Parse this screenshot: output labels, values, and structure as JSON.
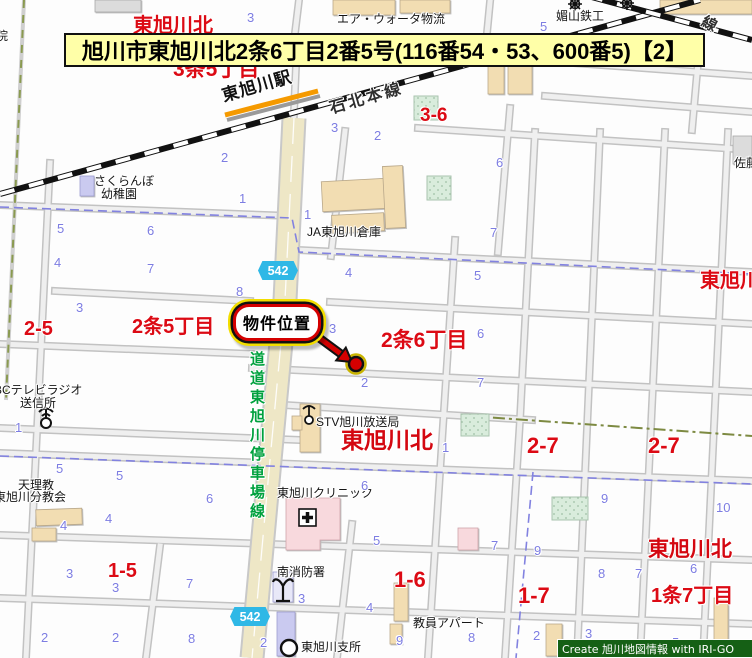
{
  "banner": {
    "text": "旭川市東旭川北2条6丁目2番5号(116番54・53、600番5)【2】"
  },
  "callout": {
    "label": "物件位置"
  },
  "credit": {
    "text": "Create 旭川地図情報 with IRI-GO"
  },
  "route_badges": [
    {
      "number": "542"
    },
    {
      "number": "542"
    }
  ],
  "colors": {
    "banner_bg": "#ffffa8",
    "area_label_red": "#dc0a14",
    "block_number_blue": "#7d7de2",
    "road_label_green": "#00a13e",
    "route_badge_cyan": "#2fb8e6",
    "pref_road_beige": "#eee7c6",
    "callout_red": "#d40000",
    "callout_outline_yellow": "#f2dd00",
    "credit_bg": "#156015",
    "platform_orange": "#f59a00"
  },
  "map_labels": [
    {
      "text": "東旭川北",
      "x": 133,
      "y": 16,
      "cls": "red",
      "size": 20,
      "name": "area-label-higashiasahikawakita-top"
    },
    {
      "text": "東旭川北",
      "x": 348,
      "y": 46,
      "cls": "red",
      "size": 20,
      "name": "area-label-higashiasahikawakita-hidden"
    },
    {
      "text": "3条5丁目",
      "x": 173,
      "y": 59,
      "cls": "red",
      "size": 21,
      "name": "area-label-3jo5chome"
    },
    {
      "text": "3-6",
      "x": 420,
      "y": 106,
      "cls": "red",
      "size": 19,
      "name": "block-label-3-6"
    },
    {
      "text": "東旭川",
      "x": 700,
      "y": 271,
      "cls": "red",
      "size": 20,
      "name": "area-label-higashiasahikawa-right"
    },
    {
      "text": "2-5",
      "x": 24,
      "y": 319,
      "cls": "red",
      "size": 20,
      "name": "block-label-2-5"
    },
    {
      "text": "2条5丁目",
      "x": 132,
      "y": 317,
      "cls": "red",
      "size": 20,
      "name": "area-label-2jo5chome"
    },
    {
      "text": "2条6丁目",
      "x": 381,
      "y": 330,
      "cls": "red",
      "size": 21,
      "name": "area-label-2jo6chome"
    },
    {
      "text": "東旭川北",
      "x": 341,
      "y": 429,
      "cls": "red-bold",
      "size": 23,
      "name": "area-label-higashiasahikawakita-center"
    },
    {
      "text": "2-7",
      "x": 527,
      "y": 435,
      "cls": "red",
      "size": 22,
      "name": "block-label-2-7a"
    },
    {
      "text": "2-7",
      "x": 648,
      "y": 435,
      "cls": "red",
      "size": 22,
      "name": "block-label-2-7b"
    },
    {
      "text": "東旭川北",
      "x": 648,
      "y": 539,
      "cls": "red-bold",
      "size": 21,
      "name": "area-label-higashiasahikawakita-bottom"
    },
    {
      "text": "1条7丁目",
      "x": 651,
      "y": 586,
      "cls": "red",
      "size": 20,
      "name": "area-label-1jo7chome"
    },
    {
      "text": "1-7",
      "x": 518,
      "y": 585,
      "cls": "red",
      "size": 22,
      "name": "block-label-1-7"
    },
    {
      "text": "1-6",
      "x": 394,
      "y": 569,
      "cls": "red",
      "size": 22,
      "name": "block-label-1-6"
    },
    {
      "text": "1-5",
      "x": 108,
      "y": 561,
      "cls": "red",
      "size": 20,
      "name": "block-label-1-5"
    },
    {
      "text": "エア・ウォータ物流",
      "x": 337,
      "y": 13,
      "cls": "poi",
      "name": "poi-air-water-logistics"
    },
    {
      "text": "媚山鉄工",
      "x": 556,
      "y": 10,
      "cls": "poi",
      "name": "poi-kobiyama-ironworks"
    },
    {
      "text": "佐藤",
      "x": 734,
      "y": 157,
      "cls": "poi",
      "name": "poi-sato"
    },
    {
      "text": "院",
      "x": -4,
      "y": 30,
      "cls": "poi",
      "name": "poi-in-cut"
    },
    {
      "text": "さくらんぼ",
      "x": 94,
      "y": 175,
      "cls": "poi",
      "name": "poi-sakuranbo"
    },
    {
      "text": "幼稚園",
      "x": 101,
      "y": 188,
      "cls": "poi",
      "name": "poi-kindergarten"
    },
    {
      "text": "JA東旭川倉庫",
      "x": 307,
      "y": 226,
      "cls": "poi",
      "name": "poi-ja-warehouse"
    },
    {
      "text": "STV旭川放送局",
      "x": 316,
      "y": 416,
      "cls": "poi",
      "name": "poi-stv-broadcast"
    },
    {
      "text": "BCテレビラジオ",
      "x": -6,
      "y": 384,
      "cls": "poi",
      "name": "poi-bc-tv-radio"
    },
    {
      "text": "送信所",
      "x": 20,
      "y": 397,
      "cls": "poi",
      "name": "poi-transmitter"
    },
    {
      "text": "天理教",
      "x": 18,
      "y": 479,
      "cls": "poi",
      "name": "poi-tenrikyo"
    },
    {
      "text": "東旭川分教会",
      "x": -6,
      "y": 491,
      "cls": "poi",
      "name": "poi-tenrikyo-church"
    },
    {
      "text": "東旭川クリニック",
      "x": 277,
      "y": 487,
      "cls": "poi",
      "name": "poi-clinic"
    },
    {
      "text": "南消防署",
      "x": 277,
      "y": 566,
      "cls": "poi",
      "name": "poi-fire-station"
    },
    {
      "text": "東旭川支所",
      "x": 301,
      "y": 641,
      "cls": "poi",
      "name": "poi-branch-office"
    },
    {
      "text": "教員アパート",
      "x": 413,
      "y": 617,
      "cls": "poi",
      "name": "poi-teachers-apartment"
    },
    {
      "text": "石北本線",
      "x": 328,
      "y": 102,
      "cls": "rail",
      "size": 16,
      "rot": -16,
      "name": "railway-label-sekihoku-line"
    },
    {
      "text": "東旭川駅",
      "x": 220,
      "y": 88,
      "cls": "station",
      "size": 17,
      "rot": -16,
      "name": "station-label-higashiasahikawa"
    },
    {
      "text": "線",
      "x": 706,
      "y": 14,
      "cls": "rail",
      "size": 15,
      "rot": 28,
      "name": "railway-label-cut"
    },
    {
      "text": "道道東旭川停車場線",
      "x": 249,
      "y": 351,
      "cls": "green-v",
      "size": 15,
      "name": "road-label-prefroad-teishajo-line"
    }
  ],
  "block_numbers": [
    {
      "text": "3",
      "x": 247,
      "y": 11
    },
    {
      "text": "5",
      "x": 540,
      "y": 20
    },
    {
      "text": "3",
      "x": 331,
      "y": 121
    },
    {
      "text": "2",
      "x": 374,
      "y": 129
    },
    {
      "text": "2",
      "x": 221,
      "y": 151
    },
    {
      "text": "1",
      "x": 239,
      "y": 192
    },
    {
      "text": "5",
      "x": 57,
      "y": 222
    },
    {
      "text": "6",
      "x": 147,
      "y": 224
    },
    {
      "text": "6",
      "x": 496,
      "y": 156
    },
    {
      "text": "4",
      "x": 54,
      "y": 256
    },
    {
      "text": "7",
      "x": 147,
      "y": 262
    },
    {
      "text": "1",
      "x": 304,
      "y": 208
    },
    {
      "text": "7",
      "x": 490,
      "y": 226
    },
    {
      "text": "8",
      "x": 236,
      "y": 285
    },
    {
      "text": "3",
      "x": 76,
      "y": 301
    },
    {
      "text": "4",
      "x": 345,
      "y": 266
    },
    {
      "text": "5",
      "x": 474,
      "y": 269
    },
    {
      "text": "3",
      "x": 329,
      "y": 322
    },
    {
      "text": "6",
      "x": 477,
      "y": 327
    },
    {
      "text": "2",
      "x": 361,
      "y": 376
    },
    {
      "text": "7",
      "x": 477,
      "y": 376
    },
    {
      "text": "1",
      "x": 442,
      "y": 441
    },
    {
      "text": "1",
      "x": 15,
      "y": 421
    },
    {
      "text": "5",
      "x": 56,
      "y": 462
    },
    {
      "text": "5",
      "x": 116,
      "y": 469
    },
    {
      "text": "6",
      "x": 206,
      "y": 492
    },
    {
      "text": "6",
      "x": 361,
      "y": 479
    },
    {
      "text": "4",
      "x": 105,
      "y": 512
    },
    {
      "text": "4",
      "x": 60,
      "y": 519
    },
    {
      "text": "9",
      "x": 601,
      "y": 492
    },
    {
      "text": "10",
      "x": 716,
      "y": 501
    },
    {
      "text": "5",
      "x": 373,
      "y": 534
    },
    {
      "text": "9",
      "x": 534,
      "y": 544
    },
    {
      "text": "7",
      "x": 491,
      "y": 539
    },
    {
      "text": "8",
      "x": 598,
      "y": 567
    },
    {
      "text": "7",
      "x": 635,
      "y": 567
    },
    {
      "text": "6",
      "x": 690,
      "y": 562
    },
    {
      "text": "3",
      "x": 66,
      "y": 567
    },
    {
      "text": "3",
      "x": 112,
      "y": 581
    },
    {
      "text": "7",
      "x": 186,
      "y": 577
    },
    {
      "text": "3",
      "x": 298,
      "y": 592
    },
    {
      "text": "4",
      "x": 366,
      "y": 601
    },
    {
      "text": "2",
      "x": 41,
      "y": 631
    },
    {
      "text": "2",
      "x": 112,
      "y": 631
    },
    {
      "text": "2",
      "x": 260,
      "y": 636
    },
    {
      "text": "8",
      "x": 188,
      "y": 632
    },
    {
      "text": "9",
      "x": 396,
      "y": 634
    },
    {
      "text": "8",
      "x": 468,
      "y": 631
    },
    {
      "text": "2",
      "x": 533,
      "y": 629
    },
    {
      "text": "3",
      "x": 585,
      "y": 627
    },
    {
      "text": "4",
      "x": 628,
      "y": 637
    },
    {
      "text": "5",
      "x": 672,
      "y": 636
    }
  ]
}
